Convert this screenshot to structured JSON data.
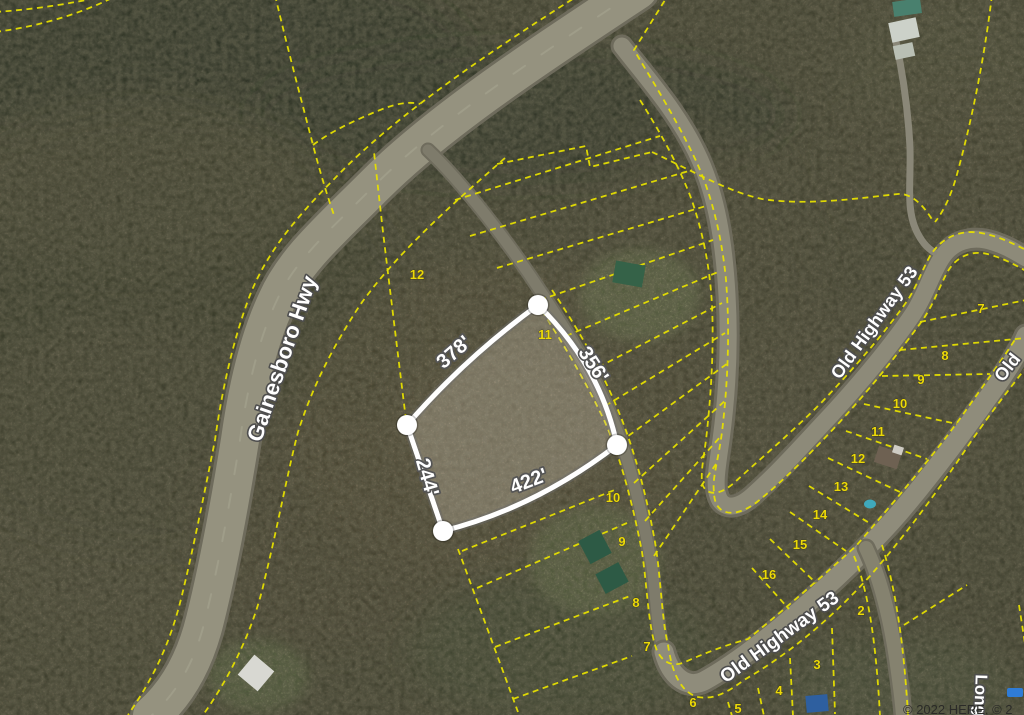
{
  "map": {
    "type": "aerial-parcel-map",
    "highlighted_parcel": {
      "lot_number": "11",
      "side_lengths": [
        "378'",
        "356'",
        "244'",
        "422'"
      ],
      "dimension_labels": [
        {
          "text": "378'",
          "x": 458,
          "y": 357,
          "rotation": -41
        },
        {
          "text": "356'",
          "x": 588,
          "y": 368,
          "rotation": 57
        },
        {
          "text": "244'",
          "x": 421,
          "y": 479,
          "rotation": 74
        },
        {
          "text": "422'",
          "x": 531,
          "y": 487,
          "rotation": -21
        }
      ]
    },
    "road_labels": [
      {
        "text": "Gainesboro Hwy",
        "x": 289,
        "y": 361,
        "rotation": -71,
        "size": 22
      },
      {
        "text": "Old Highway 53",
        "x": 879,
        "y": 326,
        "rotation": -54,
        "size": 18
      },
      {
        "text": "Old Highway 53",
        "x": 783,
        "y": 642,
        "rotation": -36,
        "size": 19
      },
      {
        "text": "Old",
        "x": 1012,
        "y": 371,
        "rotation": -52,
        "size": 18
      },
      {
        "text": "Long",
        "x": 975,
        "y": 695,
        "rotation": 92,
        "size": 17
      }
    ],
    "parcel_numbers": [
      {
        "text": "12",
        "x": 417,
        "y": 279
      },
      {
        "text": "11",
        "x": 545,
        "y": 339
      },
      {
        "text": "10",
        "x": 613,
        "y": 502
      },
      {
        "text": "9",
        "x": 622,
        "y": 546
      },
      {
        "text": "8",
        "x": 636,
        "y": 607
      },
      {
        "text": "7",
        "x": 647,
        "y": 651
      },
      {
        "text": "6",
        "x": 693,
        "y": 707
      },
      {
        "text": "5",
        "x": 738,
        "y": 713
      },
      {
        "text": "7",
        "x": 981,
        "y": 313
      },
      {
        "text": "8",
        "x": 945,
        "y": 360
      },
      {
        "text": "9",
        "x": 921,
        "y": 384
      },
      {
        "text": "10",
        "x": 900,
        "y": 408
      },
      {
        "text": "11",
        "x": 878,
        "y": 436
      },
      {
        "text": "12",
        "x": 858,
        "y": 463
      },
      {
        "text": "13",
        "x": 841,
        "y": 491
      },
      {
        "text": "14",
        "x": 820,
        "y": 519
      },
      {
        "text": "15",
        "x": 800,
        "y": 549
      },
      {
        "text": "16",
        "x": 769,
        "y": 579
      },
      {
        "text": "2",
        "x": 861,
        "y": 615
      },
      {
        "text": "3",
        "x": 817,
        "y": 669
      },
      {
        "text": "4",
        "x": 779,
        "y": 695
      }
    ],
    "attribution": "© 2022 HERE, © 2",
    "colors": {
      "parcel_line": "#e6df00",
      "lot_number": "#ecd909",
      "road_label_fill": "#ffffff",
      "road_label_stroke": "#4e4e4e",
      "highlight_outline": "#ffffff",
      "logo_blue": "#2f7cd6",
      "attribution_color": "#2b2b28"
    }
  }
}
